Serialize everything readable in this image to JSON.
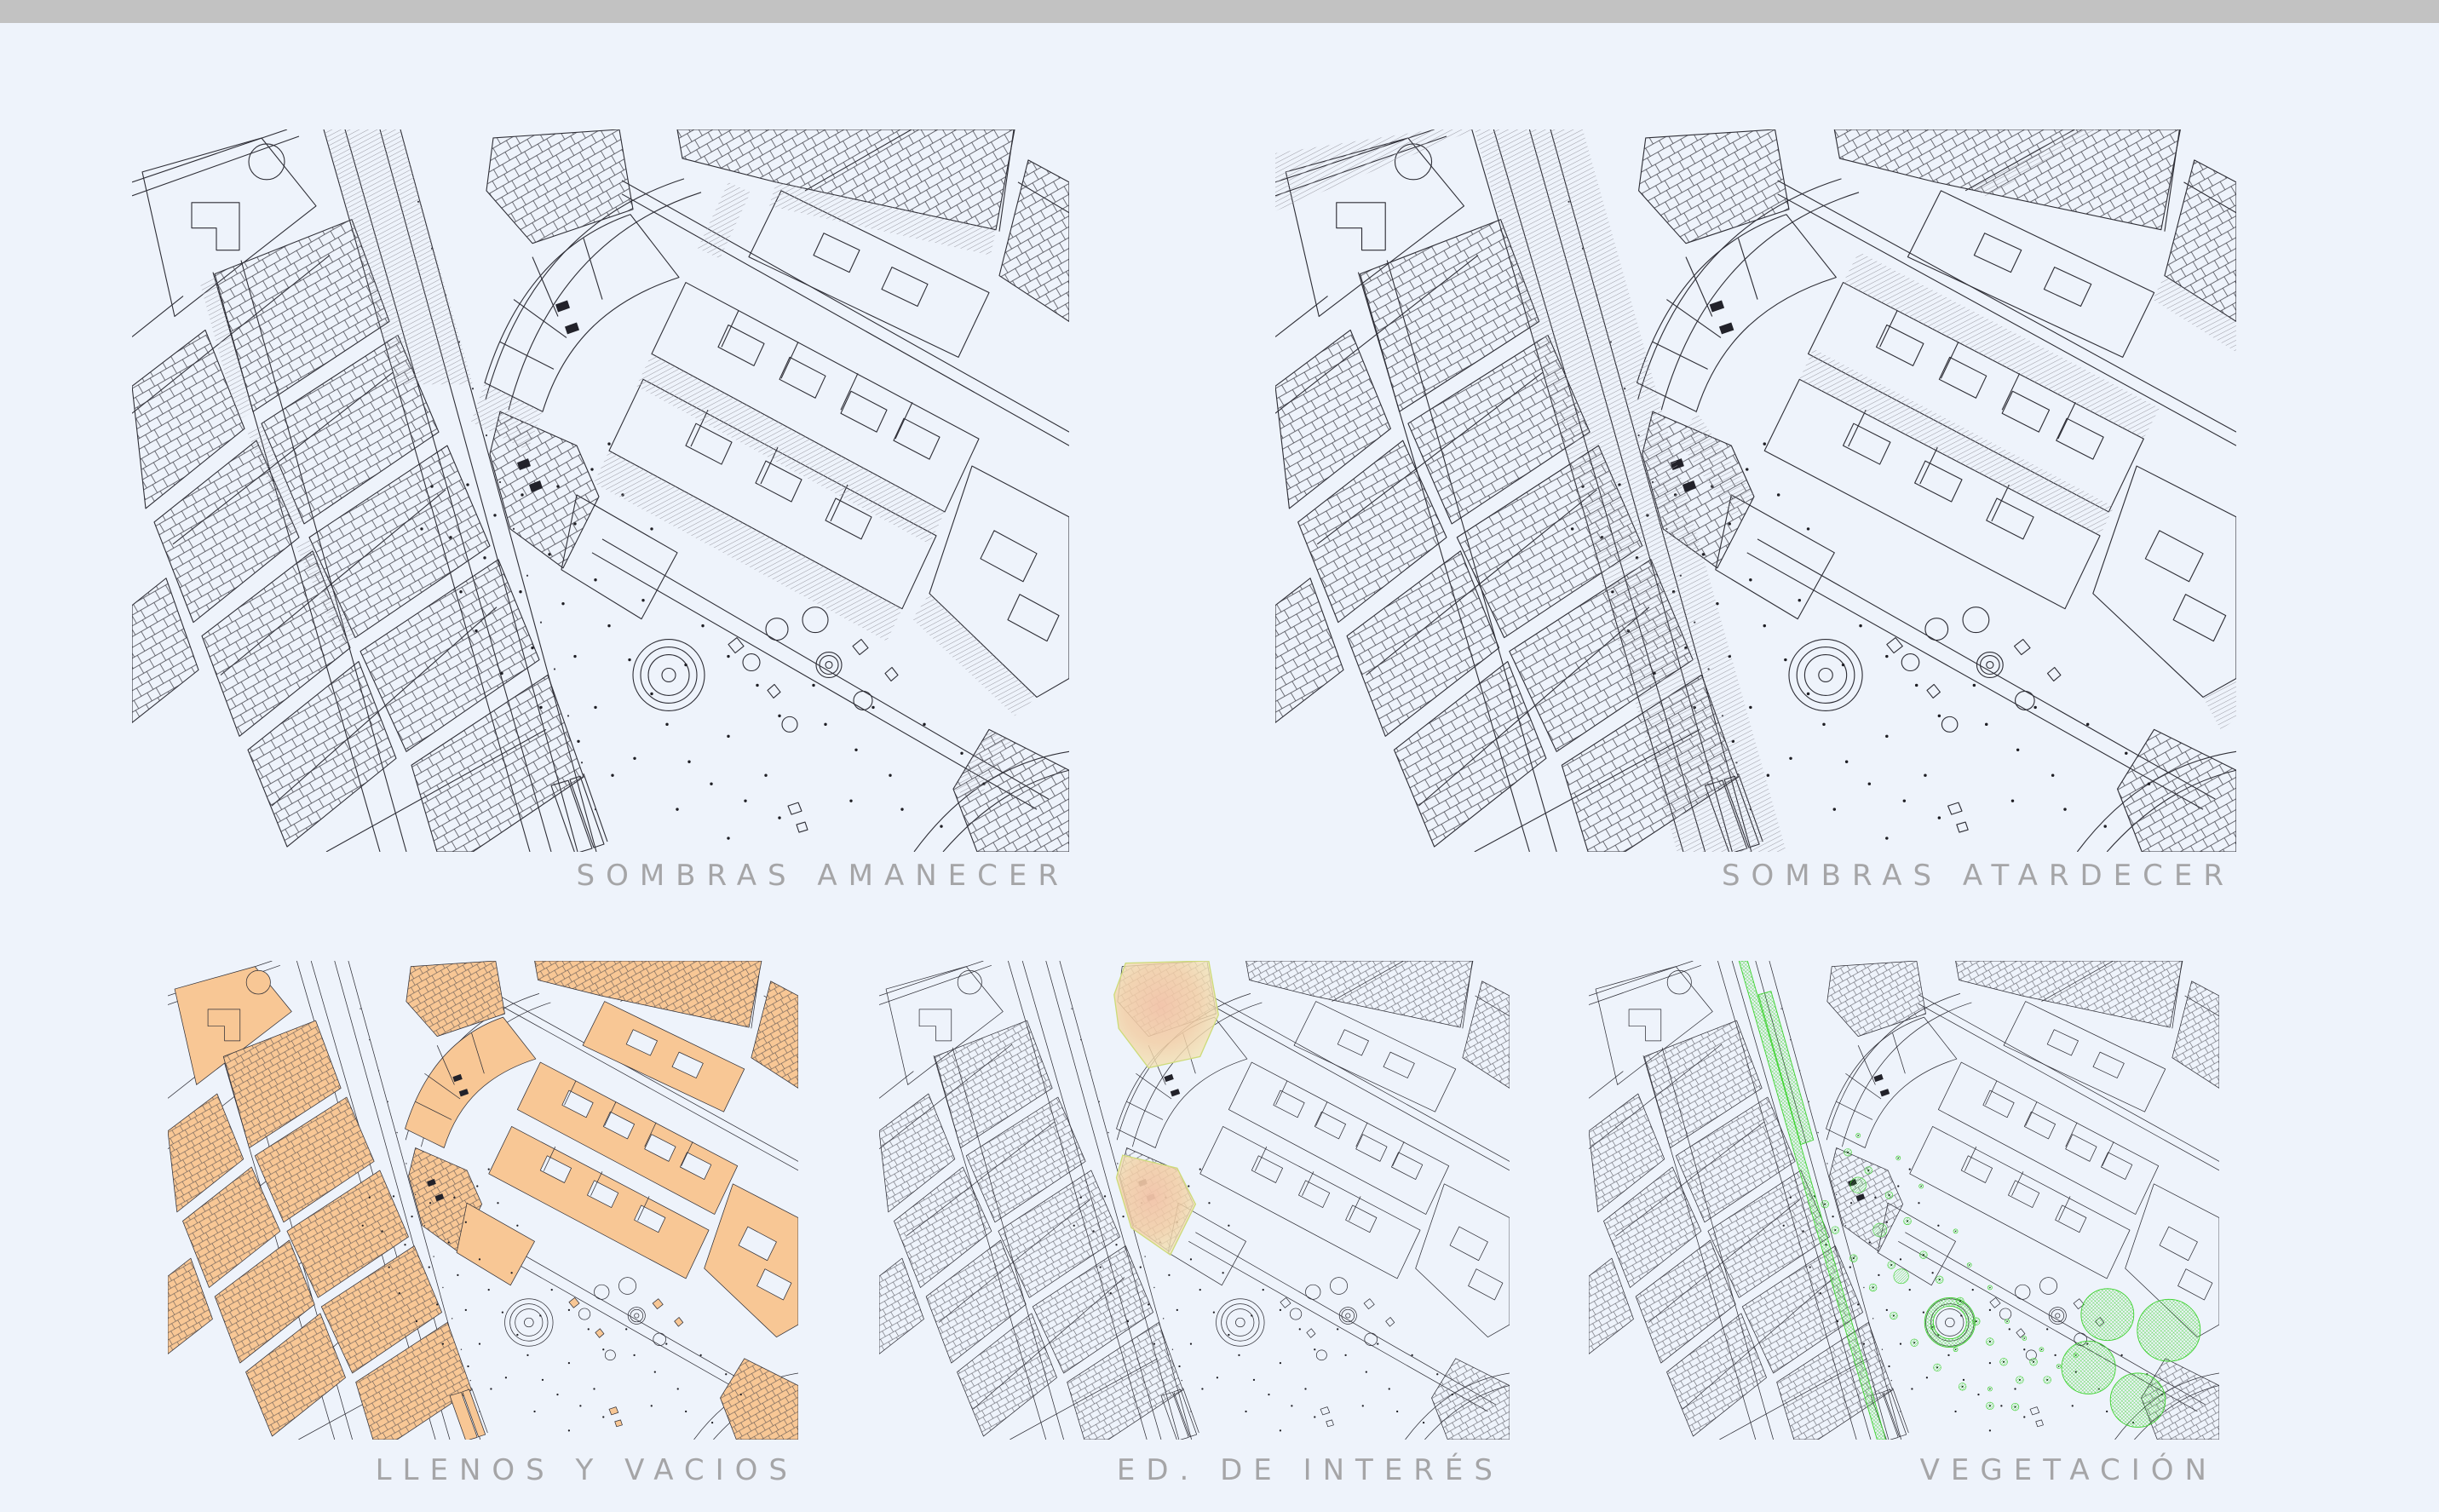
{
  "topbar": {
    "present": true
  },
  "colors": {
    "background": "#eef3fb",
    "topbar": "#c2c2c2",
    "map_line": "#2e2e36",
    "label_text": "#a5a5a7",
    "shadow_hatch": "#9b9ba4",
    "solids_fill": "#f8c795",
    "courtyard_fill": "#eef3fb",
    "highlight_core": "#f2c3a8",
    "highlight_edge": "#f2e9b8",
    "highlight_stroke": "#cddb7a",
    "vegetation_green": "#3bd22c",
    "tree_dot": "#123b0e"
  },
  "panels": [
    {
      "id": "sombras-amanecer",
      "label": "SOMBRAS AMANECER"
    },
    {
      "id": "sombras-atardecer",
      "label": "SOMBRAS ATARDECER"
    },
    {
      "id": "llenos-y-vacios",
      "label": "LLENOS Y VACIOS"
    },
    {
      "id": "ed-de-interes",
      "label": "ED. DE INTERÉS"
    },
    {
      "id": "vegetacion",
      "label": "VEGETACIÓN"
    }
  ]
}
